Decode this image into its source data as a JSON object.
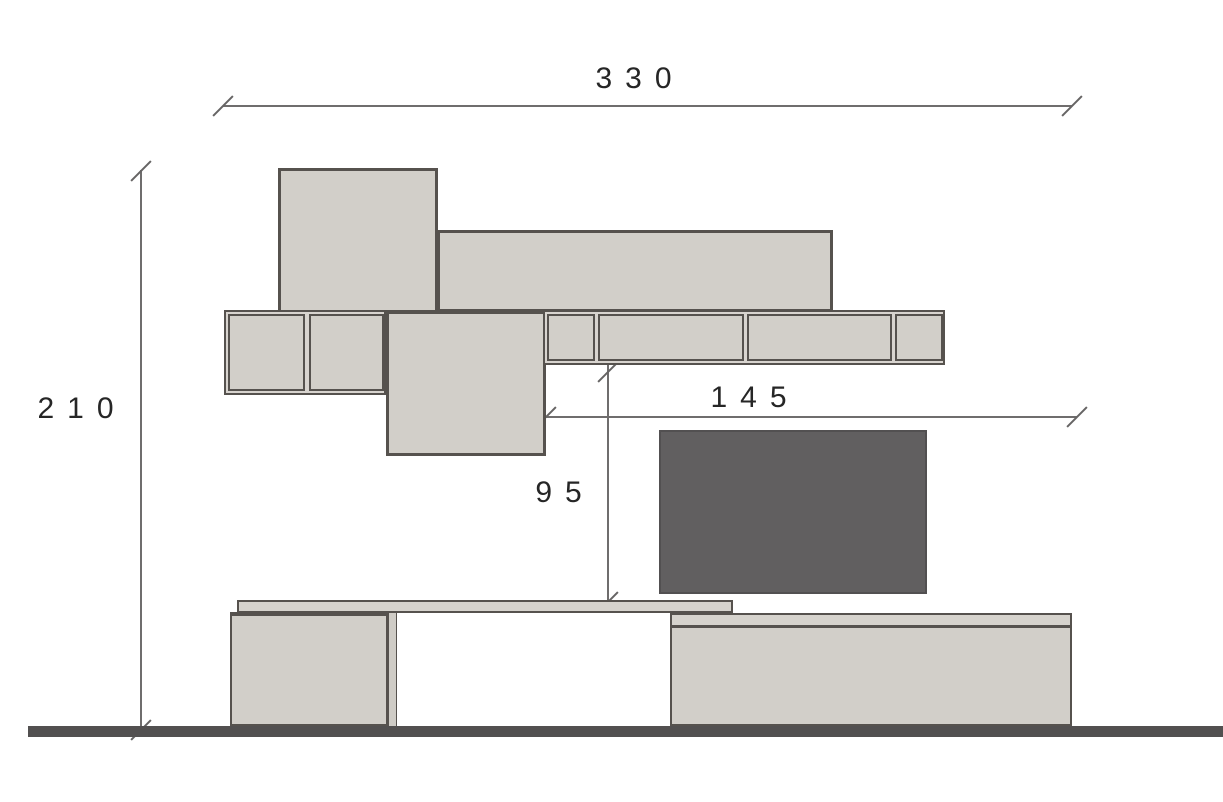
{
  "drawing": {
    "description": "Wall unit furniture elevation technical drawing",
    "dimensions": {
      "total_width": "330",
      "total_height": "210",
      "shelf_span": "145",
      "tv_gap_height": "95"
    },
    "colors": {
      "panel_fill": "#d2cfc9",
      "panel_fill_light": "#d6d3cd",
      "outline": "#56524e",
      "tv_fill": "#615f60",
      "floor": "#525050",
      "dimension_line": "#6f6d6d",
      "dimension_text": "#262626",
      "background": "#ffffff"
    }
  }
}
